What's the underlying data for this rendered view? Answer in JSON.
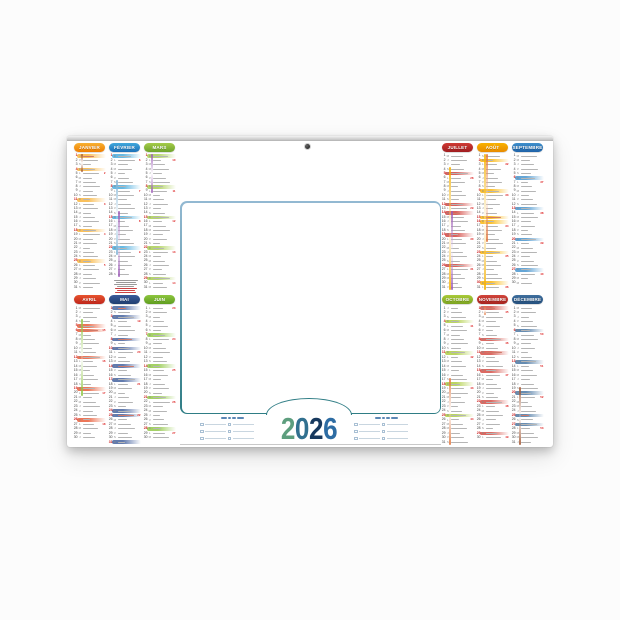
{
  "calendar": {
    "year": "2026",
    "year_digits": [
      {
        "char": "2",
        "color": "#5d9e7e"
      },
      {
        "char": "0",
        "color": "#31708f"
      },
      {
        "char": "2",
        "color": "#17395e"
      },
      {
        "char": "6",
        "color": "#2d6ca3"
      }
    ],
    "day_letters": [
      "L",
      "M",
      "M",
      "J",
      "V",
      "S",
      "D"
    ],
    "panel_border": {
      "top": "#93b9d2",
      "bottom": "#2f7d85"
    },
    "months": [
      {
        "label": "JANVIER",
        "c1": "#f8b133",
        "c2": "#ef7d00",
        "days": 31,
        "start_dow": 3,
        "holidays": [
          1
        ],
        "vacations": [
          {
            "from": 1,
            "to": 4,
            "color": "#a0522d"
          }
        ]
      },
      {
        "label": "FÉVRIER",
        "c1": "#41a8dc",
        "c2": "#1d71b8",
        "days": 28,
        "start_dow": 6,
        "holidays": [],
        "vacations": [
          {
            "from": 7,
            "to": 23,
            "color": "#7fb3d5"
          },
          {
            "from": 14,
            "to": 28,
            "color": "#9b59b6"
          }
        ]
      },
      {
        "label": "MARS",
        "c1": "#a5cc4a",
        "c2": "#6fa32b",
        "days": 31,
        "start_dow": 6,
        "holidays": [],
        "vacations": [
          {
            "from": 1,
            "to": 9,
            "color": "#9b59b6"
          }
        ]
      },
      {
        "label": "AVRIL",
        "c1": "#e8542e",
        "c2": "#c0271c",
        "days": 30,
        "start_dow": 2,
        "holidays": [
          6
        ],
        "vacations": [
          {
            "from": 4,
            "to": 20,
            "color": "#8bc53f"
          }
        ]
      },
      {
        "label": "MAI",
        "c1": "#3b5a9a",
        "c2": "#1f3e70",
        "days": 31,
        "start_dow": 4,
        "holidays": [
          1,
          8,
          14,
          25
        ],
        "vacations": []
      },
      {
        "label": "JUIN",
        "c1": "#8ec63f",
        "c2": "#5f9e1f",
        "days": 30,
        "start_dow": 0,
        "holidays": [],
        "vacations": []
      },
      {
        "label": "JUILLET",
        "c1": "#d03a34",
        "c2": "#a01d20",
        "days": 31,
        "start_dow": 2,
        "holidays": [
          14
        ],
        "vacations": [
          {
            "from": 4,
            "to": 31,
            "color": "#f4b000"
          },
          {
            "from": 14,
            "to": 31,
            "color": "#9b59b6"
          }
        ]
      },
      {
        "label": "AOÛT",
        "c1": "#f9b200",
        "c2": "#e88b00",
        "days": 31,
        "start_dow": 5,
        "holidays": [
          15
        ],
        "vacations": [
          {
            "from": 1,
            "to": 31,
            "color": "#f4b000"
          },
          {
            "from": 1,
            "to": 20,
            "color": "#e2743a"
          }
        ]
      },
      {
        "label": "SEPTEMBRE",
        "c1": "#3e8fcc",
        "c2": "#1f63a8",
        "days": 30,
        "start_dow": 1,
        "holidays": [],
        "vacations": []
      },
      {
        "label": "OCTOBRE",
        "c1": "#aacb39",
        "c2": "#7ba421",
        "days": 31,
        "start_dow": 3,
        "holidays": [],
        "vacations": [
          {
            "from": 17,
            "to": 31,
            "color": "#e2743a"
          }
        ]
      },
      {
        "label": "NOVEMBRE",
        "c1": "#d2453c",
        "c2": "#a8231e",
        "days": 30,
        "start_dow": 6,
        "holidays": [
          1,
          11
        ],
        "vacations": [
          {
            "from": 1,
            "to": 2,
            "color": "#e2743a"
          }
        ]
      },
      {
        "label": "DÉCEMBRE",
        "c1": "#3f6f9e",
        "c2": "#24507e",
        "days": 31,
        "start_dow": 1,
        "holidays": [
          25
        ],
        "vacations": [
          {
            "from": 19,
            "to": 31,
            "color": "#a0522d"
          }
        ]
      }
    ]
  }
}
